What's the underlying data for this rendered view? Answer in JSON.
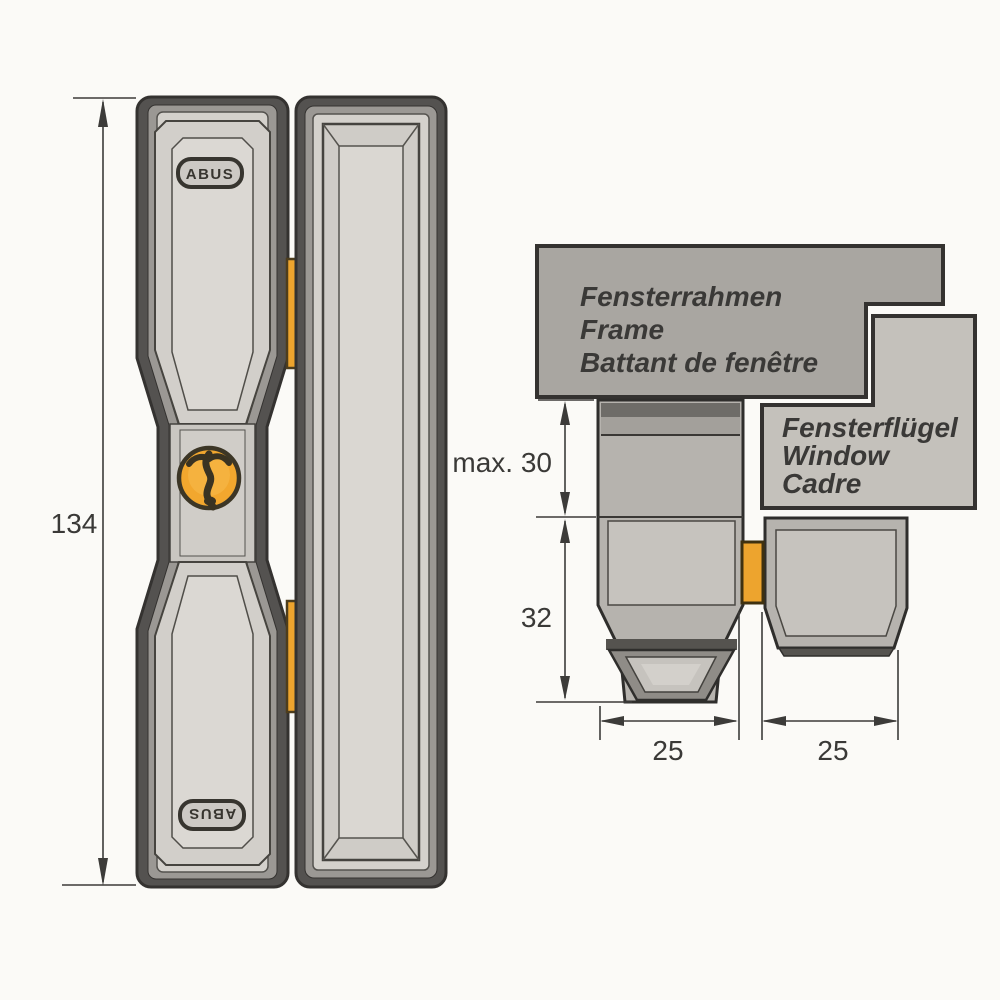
{
  "title": "ABUS window lock installation drawing",
  "colors": {
    "background": "#fbfaf7",
    "outline": "#343230",
    "dark_metal": "#545250",
    "mid_metal": "#9b9894",
    "light_face": "#d4d1cc",
    "frame_box": "#a9a6a1",
    "sash_box": "#c4c1bb",
    "side_body": "#b6b3ae",
    "side_panel": "#c6c3be",
    "dark_band": "#6e6c68",
    "bolt_orange": "#eda42e",
    "keyhole_orange": "#f2a72e",
    "keyhole_dark": "#3a3322",
    "dim_line": "#3c3b39",
    "text": "#3a3937"
  },
  "front_view": {
    "height_dimension": "134",
    "lock_brand_top": "ABUS",
    "lock_brand_bottom": "ABUS"
  },
  "section_view": {
    "frame_label": {
      "de": "Fensterrahmen",
      "en": "Frame",
      "fr": "Battant de fenêtre"
    },
    "sash_label": {
      "de": "Fensterflügel",
      "en": "Window",
      "fr": "Cadre"
    },
    "depth_dimension": "max. 30",
    "body_height_dimension": "32",
    "lock_width_dimension": "25",
    "strike_width_dimension": "25"
  }
}
